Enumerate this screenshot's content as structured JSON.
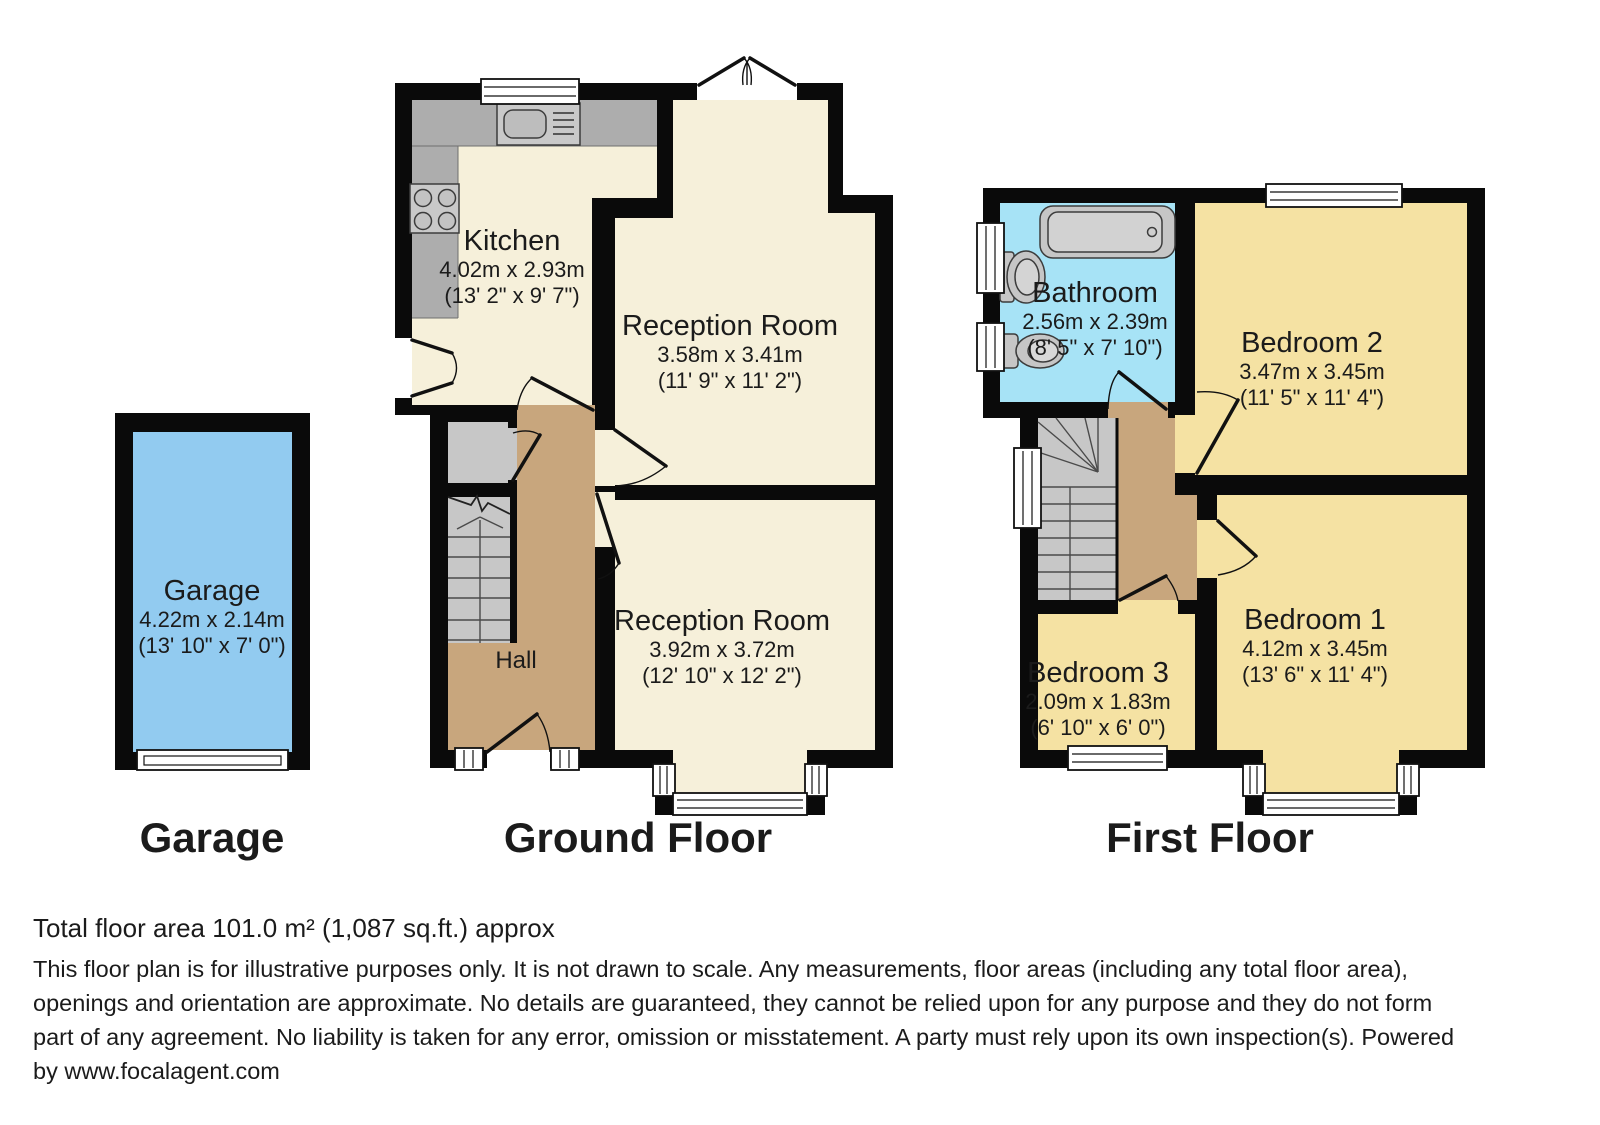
{
  "colors": {
    "wall": "#0a0a0a",
    "floor_cream": "#f6f0da",
    "bedroom_yellow": "#f5e2a3",
    "bathroom_blue": "#a7e3f6",
    "garage_blue": "#92cbf0",
    "hall_tan": "#c8a67d",
    "stair_gray": "#c7c7c7",
    "counter_gray": "#adadad",
    "fixture_gray": "#c9c9c9"
  },
  "floors": {
    "garage": {
      "label": "Garage"
    },
    "ground": {
      "label": "Ground Floor"
    },
    "first": {
      "label": "First Floor"
    }
  },
  "rooms": {
    "garage": {
      "name": "Garage",
      "metric": "4.22m x 2.14m",
      "imperial": "(13' 10\" x 7' 0\")"
    },
    "kitchen": {
      "name": "Kitchen",
      "metric": "4.02m x 2.93m",
      "imperial": "(13' 2\" x 9' 7\")"
    },
    "reception1": {
      "name": "Reception Room",
      "metric": "3.58m x 3.41m",
      "imperial": "(11' 9\" x 11' 2\")"
    },
    "reception2": {
      "name": "Reception Room",
      "metric": "3.92m x 3.72m",
      "imperial": "(12' 10\" x 12' 2\")"
    },
    "hall": {
      "name": "Hall"
    },
    "bathroom": {
      "name": "Bathroom",
      "metric": "2.56m x 2.39m",
      "imperial": "(8' 5\" x 7' 10\")"
    },
    "bedroom1": {
      "name": "Bedroom 1",
      "metric": "4.12m x 3.45m",
      "imperial": "(13' 6\" x 11' 4\")"
    },
    "bedroom2": {
      "name": "Bedroom 2",
      "metric": "3.47m x 3.45m",
      "imperial": "(11' 5\" x 11' 4\")"
    },
    "bedroom3": {
      "name": "Bedroom 3",
      "metric": "2.09m x 1.83m",
      "imperial": "(6' 10\" x 6' 0\")"
    }
  },
  "footer": {
    "total_area": "Total floor area 101.0 m² (1,087 sq.ft.) approx",
    "disclaimer_lines": [
      "This floor plan is for illustrative purposes only. It is not drawn to scale. Any measurements, floor areas (including any total floor area),",
      "openings and orientation are approximate. No details are guaranteed, they cannot be relied upon for any purpose and they do not form",
      "part of any agreement. No liability is taken for any error, omission or misstatement. A party must rely upon its own inspection(s). Powered",
      "by www.focalagent.com"
    ]
  }
}
